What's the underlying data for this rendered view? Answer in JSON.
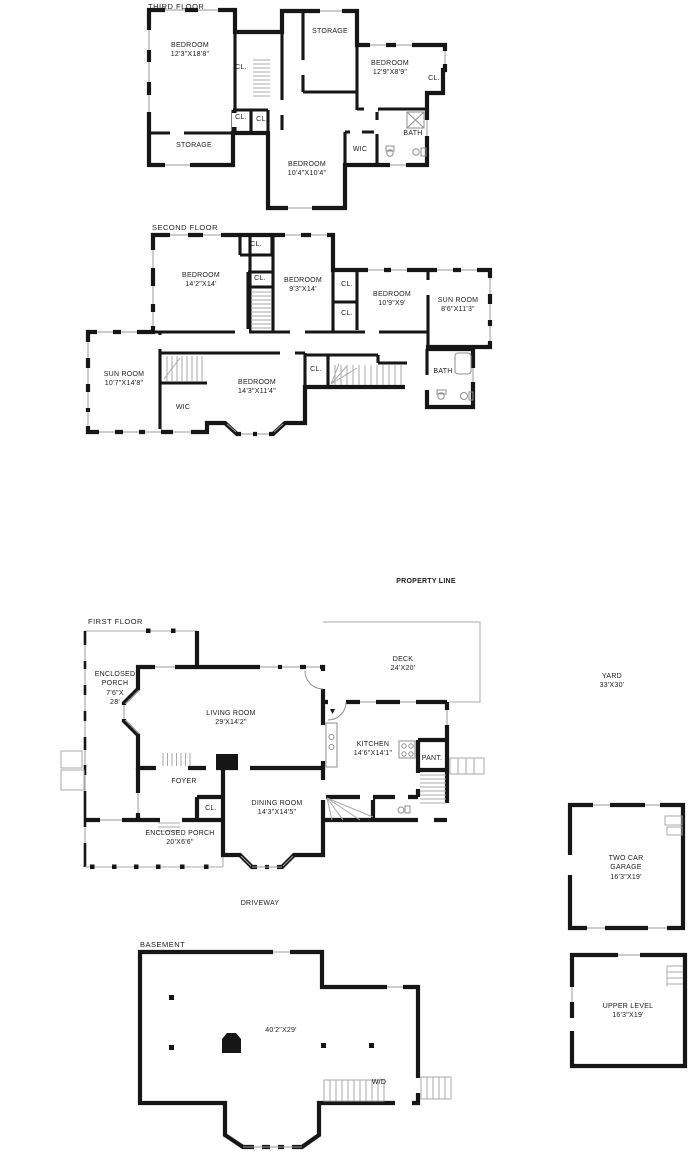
{
  "sheet": {
    "background": "#ffffff",
    "wall_color": "#161616"
  },
  "floors": {
    "third": {
      "title": "THIRD FLOOR",
      "rooms": {
        "bedroom_left": {
          "name": "BEDROOM",
          "dims": "12'3\"X18'8\""
        },
        "storage_top": {
          "name": "STORAGE"
        },
        "bedroom_right": {
          "name": "BEDROOM",
          "dims": "12'9\"X8'9\""
        },
        "closet_right": {
          "name": "CL."
        },
        "closet_hall_top": {
          "name": "CL."
        },
        "closet_hall_left": {
          "name": "CL."
        },
        "closet_hall_right": {
          "name": "CL."
        },
        "storage_bottom": {
          "name": "STORAGE"
        },
        "bedroom_bottom": {
          "name": "BEDROOM",
          "dims": "10'4\"X10'4\""
        },
        "wic": {
          "name": "WIC"
        },
        "bath": {
          "name": "BATH"
        }
      }
    },
    "second": {
      "title": "SECOND FLOOR",
      "rooms": {
        "bedroom_nw": {
          "name": "BEDROOM",
          "dims": "14'2\"X14'"
        },
        "closet_top": {
          "name": "CL."
        },
        "closet_stairs": {
          "name": "CL."
        },
        "bedroom_n": {
          "name": "BEDROOM",
          "dims": "9'3\"X14'"
        },
        "closet_east_upper": {
          "name": "CL."
        },
        "closet_east_lower": {
          "name": "CL."
        },
        "bedroom_ne": {
          "name": "BEDROOM",
          "dims": "10'9\"X9'"
        },
        "sunroom_ne": {
          "name": "SUN ROOM",
          "dims": "8'6\"X11'3\""
        },
        "sunroom_sw": {
          "name": "SUN ROOM",
          "dims": "10'7\"X14'8\""
        },
        "wic": {
          "name": "WIC"
        },
        "bedroom_s": {
          "name": "BEDROOM",
          "dims": "14'3\"X11'4\""
        },
        "closet_mid": {
          "name": "CL."
        },
        "bath": {
          "name": "BATH"
        }
      }
    },
    "first": {
      "title": "FIRST FLOOR",
      "rooms": {
        "enclosed_porch_west": {
          "line1": "ENCLOSED",
          "line2": "PORCH",
          "line3": "7'6\"X",
          "line4": "28'"
        },
        "living": {
          "name": "LIVING ROOM",
          "dims": "29'X14'2\""
        },
        "kitchen": {
          "name": "KITCHEN",
          "dims": "14'6\"X14'1\""
        },
        "pantry": {
          "name": "PANT."
        },
        "foyer": {
          "name": "FOYER"
        },
        "closet": {
          "name": "CL."
        },
        "dining": {
          "name": "DINING ROOM",
          "dims": "14'3\"X14'5\""
        },
        "enclosed_porch_south": {
          "name": "ENCLOSED PORCH",
          "dims": "20'X6'6\""
        }
      }
    },
    "basement": {
      "title": "BASEMENT",
      "dims": "40'2\"X29'",
      "washer_dryer": "W/D"
    }
  },
  "site": {
    "property_line": "PROPERTY LINE",
    "deck": {
      "name": "DECK",
      "dims": "24'X20'"
    },
    "driveway": "DRIVEWAY",
    "yard": {
      "name": "YARD",
      "dims": "33'X30'"
    },
    "garage": {
      "line1": "TWO CAR",
      "line2": "GARAGE",
      "dims": "16'3\"X19'"
    },
    "upper_level": {
      "name": "UPPER LEVEL",
      "dims": "16'3\"X19'"
    }
  }
}
